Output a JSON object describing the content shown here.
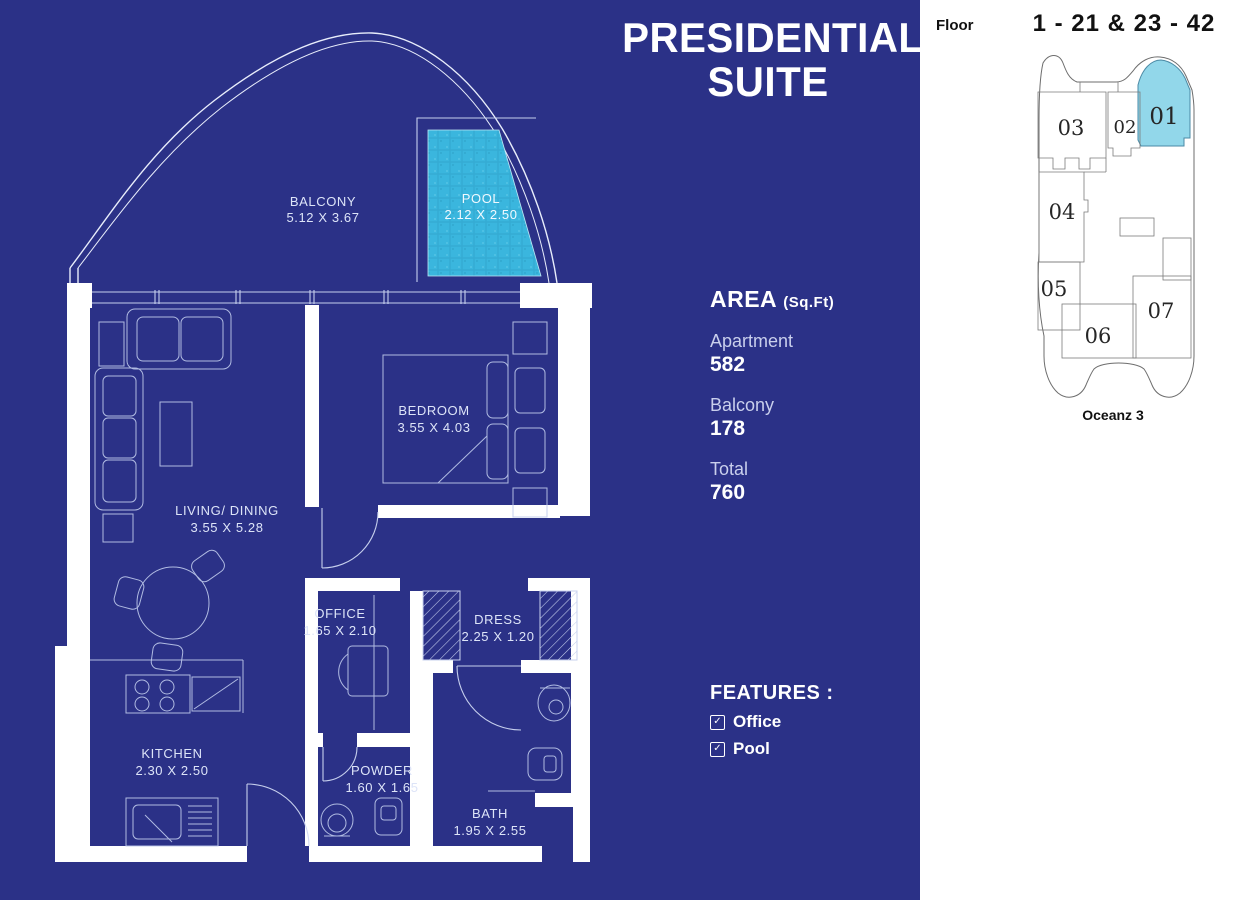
{
  "title": {
    "line1": "PRESIDENTIAL",
    "line2": "SUITE"
  },
  "area": {
    "heading": "AREA",
    "unit": "(Sq.Ft)",
    "items": [
      {
        "label": "Apartment",
        "value": "582"
      },
      {
        "label": "Balcony",
        "value": "178"
      },
      {
        "label": "Total",
        "value": "760"
      }
    ]
  },
  "features": {
    "heading": "FEATURES :",
    "items": [
      {
        "label": "Office",
        "checked": true
      },
      {
        "label": "Pool",
        "checked": true
      }
    ]
  },
  "floor_plan": {
    "rooms": [
      {
        "name": "BALCONY",
        "dims": "5.12 X 3.67"
      },
      {
        "name": "POOL",
        "dims": "2.12 X 2.50"
      },
      {
        "name": "BEDROOM",
        "dims": "3.55 X 4.03"
      },
      {
        "name": "LIVING/ DINING",
        "dims": "3.55 X 5.28"
      },
      {
        "name": "OFFICE",
        "dims": "1.65 X 2.10"
      },
      {
        "name": "DRESS",
        "dims": "2.25 X 1.20"
      },
      {
        "name": "KITCHEN",
        "dims": "2.30 X 2.50"
      },
      {
        "name": "POWDER",
        "dims": "1.60 X 1.65"
      },
      {
        "name": "BATH",
        "dims": "1.95 X 2.55"
      }
    ]
  },
  "key_plan": {
    "floor_label": "Floor",
    "floor_range": "1 - 21 & 23 - 42",
    "building_name": "Oceanz 3",
    "highlighted_unit": "01",
    "units": [
      {
        "number": "01",
        "highlighted": true
      },
      {
        "number": "02",
        "highlighted": false
      },
      {
        "number": "03",
        "highlighted": false
      },
      {
        "number": "04",
        "highlighted": false
      },
      {
        "number": "05",
        "highlighted": false
      },
      {
        "number": "06",
        "highlighted": false
      },
      {
        "number": "07",
        "highlighted": false
      }
    ]
  },
  "colors": {
    "background_blue": "#2b3187",
    "pool_cyan": "#3ab6de",
    "unit_highlight_cyan": "#92d7ea",
    "plan_line": "#d5ddf5",
    "text_light": "#c9cfec"
  }
}
